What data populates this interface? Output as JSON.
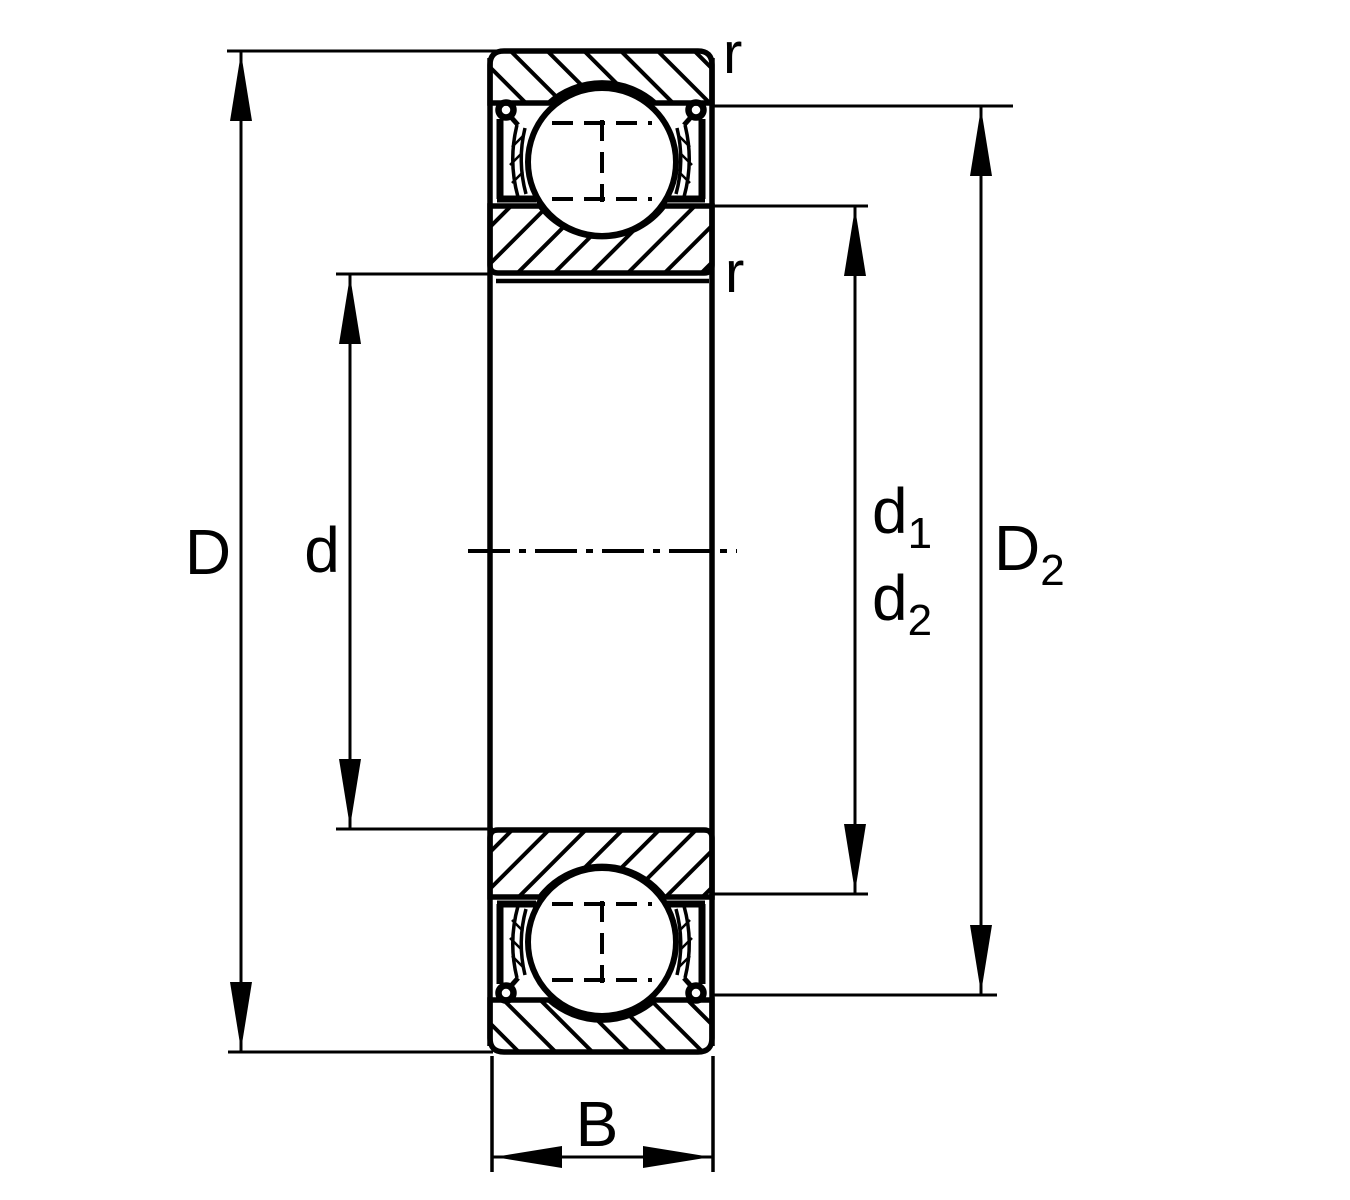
{
  "colors": {
    "ink": "#000000",
    "paper": "#ffffff"
  },
  "labels": {
    "outer_diameter": "D",
    "bore_diameter": "d",
    "width": "B",
    "chamfer_outer": "r",
    "chamfer_inner": "r",
    "d1": {
      "base": "d",
      "sub": "1"
    },
    "d2": {
      "base": "d",
      "sub": "2"
    },
    "D2": {
      "base": "D",
      "sub": "2"
    }
  }
}
